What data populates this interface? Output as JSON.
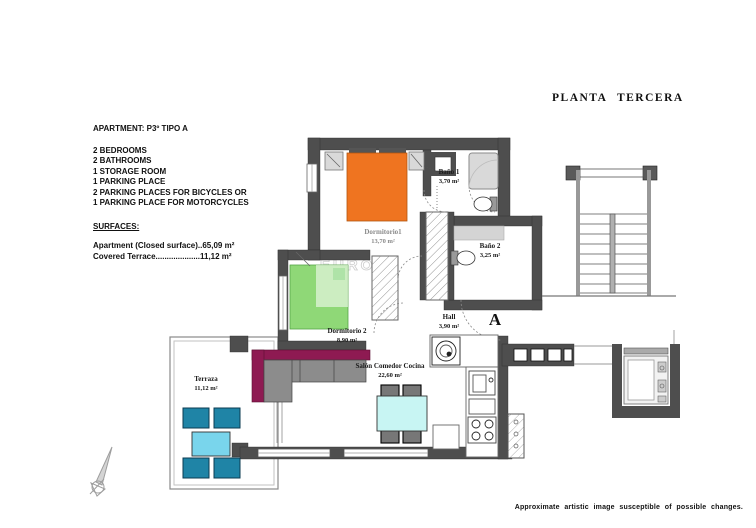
{
  "title": "PLANTA TERCERA",
  "info": {
    "apartment_line": "APARTMENT: P3º TIPO A",
    "features": [
      "2 BEDROOMS",
      "2 BATHROOMS",
      "1 STORAGE ROOM",
      "1 PARKING PLACE",
      "2 PARKING PLACES FOR BICYCLES OR",
      "1 PARKING PLACE FOR MOTORCYCLES"
    ],
    "surfaces_heading": "SURFACES:",
    "surfaces": [
      "Apartment (Closed surface)..65,09 m²",
      "Covered Terrace....................11,12 m²"
    ]
  },
  "rooms": {
    "dormitorio1": {
      "name": "Dormitorio1",
      "area": "13,70 m²"
    },
    "bano1": {
      "name": "Baño 1",
      "area": "3,70 m²"
    },
    "bano2": {
      "name": "Baño 2",
      "area": "3,25 m²"
    },
    "dormitorio2": {
      "name": "Dormitorio 2",
      "area": "8,90 m²"
    },
    "hall": {
      "name": "Hall",
      "area": "3,90 m²"
    },
    "salon": {
      "name": "Salón Comedor Cocina",
      "area": "22,60 m²"
    },
    "terraza": {
      "name": "Terraza",
      "area": "11,12 m²"
    }
  },
  "section_marker": "A",
  "watermark": "EUROPA",
  "disclaimer": "Approximate artistic image susceptible of possible changes.",
  "colors": {
    "wall": "#4e4e4e",
    "bed1": "#ef7420",
    "bed2": "#8fd877",
    "bed2_pillow": "#4ec23e",
    "sofa": "#8e1a52",
    "cushion": "#8c8c8c",
    "dining_table": "#c8f5f3",
    "terrace_chair": "#1f84a6",
    "terrace_table": "#79d5ec",
    "fixture_gray": "#d9d9d9"
  }
}
